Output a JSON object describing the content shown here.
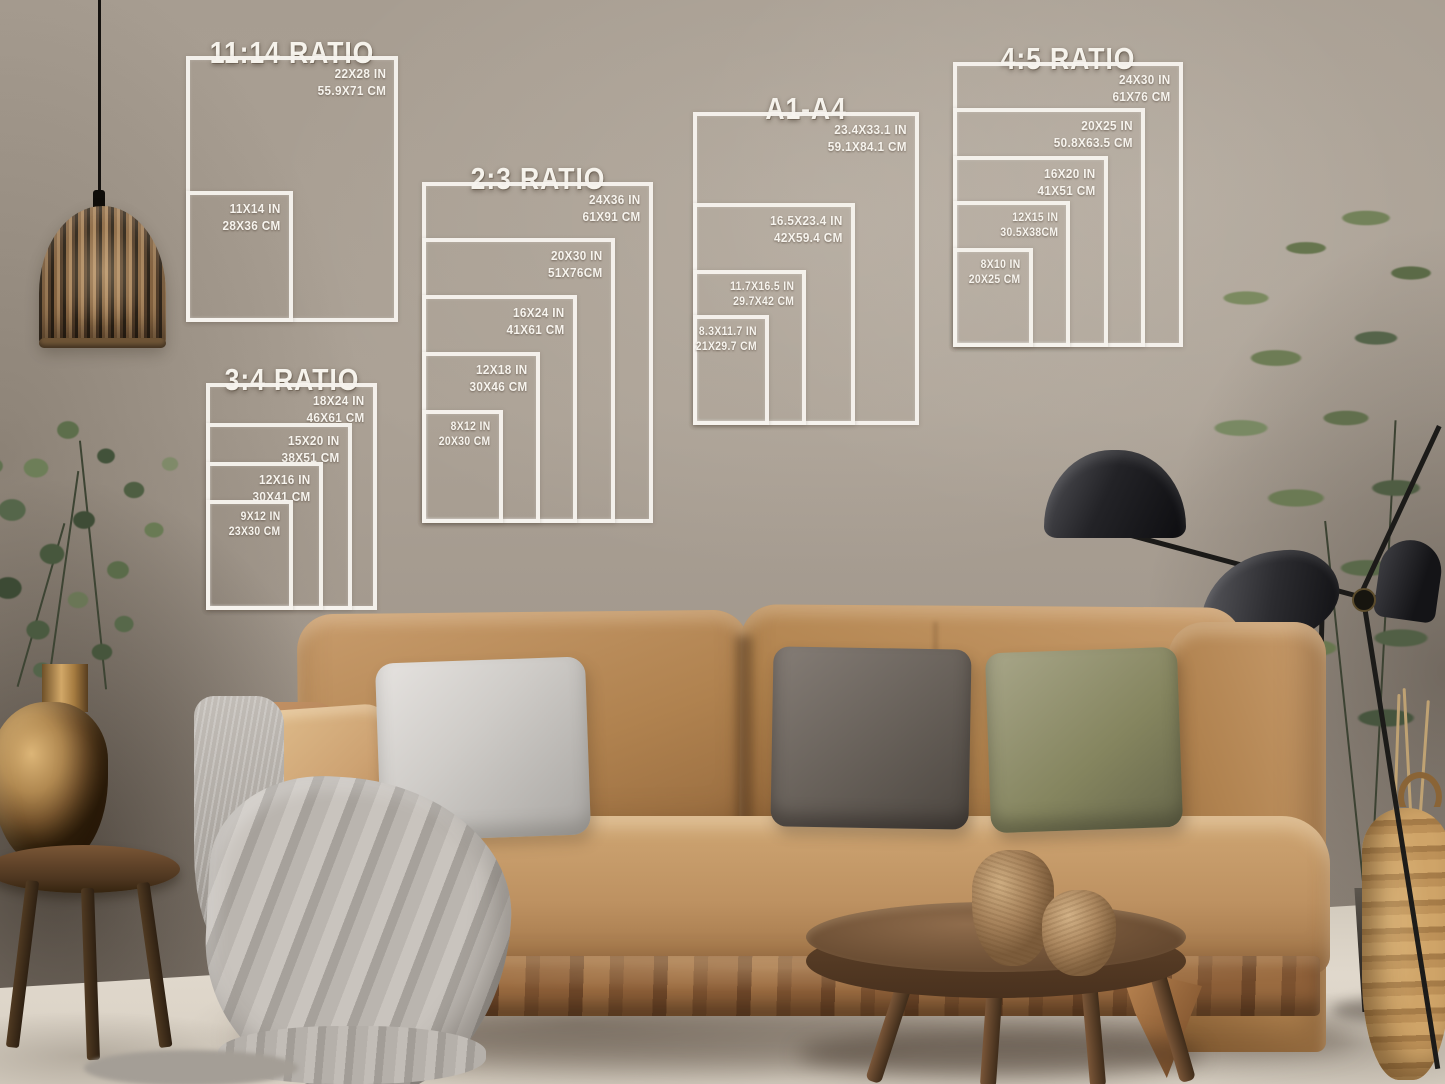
{
  "size_guides": [
    {
      "id": "11-14",
      "title": "11:14 RATIO",
      "boxes": [
        {
          "inches": "22X28 IN",
          "cm": "55.9X71 CM"
        },
        {
          "inches": "11X14 IN",
          "cm": "28X36 CM"
        }
      ]
    },
    {
      "id": "2-3",
      "title": "2:3 RATIO",
      "boxes": [
        {
          "inches": "24X36 IN",
          "cm": "61X91 CM"
        },
        {
          "inches": "20X30 IN",
          "cm": "51X76CM"
        },
        {
          "inches": "16X24 IN",
          "cm": "41X61 CM"
        },
        {
          "inches": "12X18 IN",
          "cm": "30X46 CM"
        },
        {
          "inches": "8X12 IN",
          "cm": "20X30 CM"
        }
      ]
    },
    {
      "id": "3-4",
      "title": "3:4 RATIO",
      "boxes": [
        {
          "inches": "18X24 IN",
          "cm": "46X61 CM"
        },
        {
          "inches": "15X20 IN",
          "cm": "38X51 CM"
        },
        {
          "inches": "12X16 IN",
          "cm": "30X41 CM"
        },
        {
          "inches": "9X12 IN",
          "cm": "23X30 CM"
        }
      ]
    },
    {
      "id": "a1-a4",
      "title": "A1-A4",
      "boxes": [
        {
          "inches": "23.4X33.1 IN",
          "cm": "59.1X84.1 CM"
        },
        {
          "inches": "16.5X23.4 IN",
          "cm": "42X59.4 CM"
        },
        {
          "inches": "11.7X16.5 IN",
          "cm": "29.7X42 CM"
        },
        {
          "inches": "8.3X11.7 IN",
          "cm": "21X29.7 CM"
        }
      ]
    },
    {
      "id": "4-5",
      "title": "4:5 RATIO",
      "boxes": [
        {
          "inches": "24X30 IN",
          "cm": "61X76 CM"
        },
        {
          "inches": "20X25 IN",
          "cm": "50.8X63.5 CM"
        },
        {
          "inches": "16X20 IN",
          "cm": "41X51 CM"
        },
        {
          "inches": "12X15 IN",
          "cm": "30.5X38CM"
        },
        {
          "inches": "8X10 IN",
          "cm": "20X25 CM"
        }
      ]
    }
  ],
  "palette": {
    "overlay_line": "#f4f1ea",
    "wall": "#a89e92",
    "floor": "#ddd5c8",
    "sofa_camel": "#b8895a",
    "pillow_gray_light": "#cfccc8",
    "pillow_gray_dark": "#665f58",
    "pillow_olive": "#85855f",
    "throw_gray": "#b5b0aa",
    "wood_walnut": "#6f5136",
    "brass": "#b68a50",
    "lamp_black": "#1a191b",
    "plant_green": "#6f7f58",
    "basket_tan": "#bd9258"
  }
}
